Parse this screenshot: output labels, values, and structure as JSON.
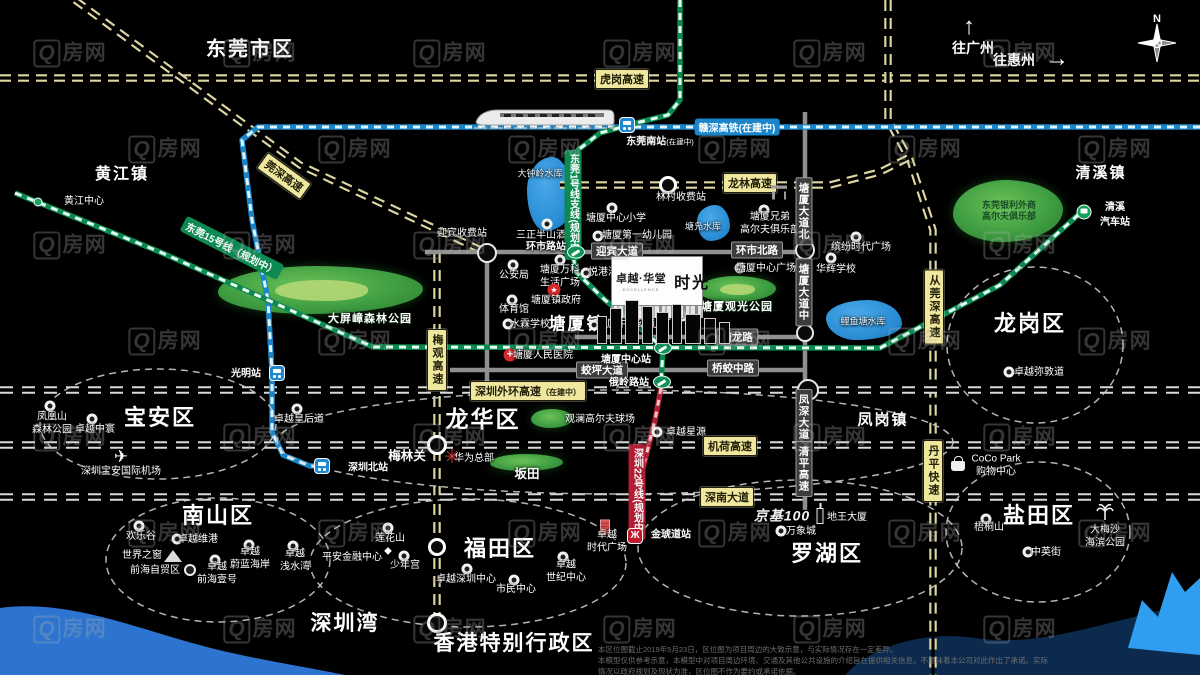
{
  "meta": {
    "title": "卓越·华堂 时光 区位图",
    "width": 1200,
    "height": 675
  },
  "colors": {
    "background": "#000000",
    "highway_label_bg": "#efe79e",
    "highway_dash": "#ddd6a0",
    "boundary_dash": "#d9d9d9",
    "road_gray": "#8f8f8f",
    "rail_green": "#0c8a52",
    "rail_cyan": "#1a86c9",
    "rail_red": "#b01e33",
    "park_green": "#3f9e42",
    "lake_blue": "#2b8fd6",
    "water_left": "#2c74cf",
    "water_navy": "#0c2a4e",
    "water_bright": "#2f9df0"
  },
  "property_logo": {
    "name": "卓越·华堂",
    "sub": "EXCELLENCE",
    "product": "时光"
  },
  "nav": {
    "to_guangzhou": "往广州",
    "to_huizhou": "往惠州",
    "north": "N"
  },
  "watermark": {
    "q": "Q",
    "text": "房网"
  },
  "disclaimer": {
    "line1": "本区位图截止2019年5月23日，区位图为项目周边的大致示意，与实际情况存在一定差异。",
    "line2": "本模型仅供参考示意，本模型中对项目周边环境、交通及其他公共设施的介绍旨在提供相关信息，不意味着本公司对此作出了承诺。实际情况以政府规划及现状为准，区位图不作为要约或承诺依据。"
  },
  "regions": [
    {
      "t": "东莞市区",
      "x": 250,
      "y": 47,
      "s": 20
    },
    {
      "t": "黄江镇",
      "x": 122,
      "y": 172,
      "s": 16
    },
    {
      "t": "清溪镇",
      "x": 1101,
      "y": 172,
      "s": 15
    },
    {
      "t": "塘厦镇",
      "x": 577,
      "y": 322,
      "s": 17
    },
    {
      "t": "凤岗镇",
      "x": 883,
      "y": 419,
      "s": 15
    },
    {
      "t": "龙岗区",
      "x": 1030,
      "y": 322,
      "s": 22
    },
    {
      "t": "宝安区",
      "x": 160,
      "y": 416,
      "s": 22
    },
    {
      "t": "龙华区",
      "x": 483,
      "y": 417,
      "s": 23
    },
    {
      "t": "南山区",
      "x": 218,
      "y": 514,
      "s": 22
    },
    {
      "t": "福田区",
      "x": 500,
      "y": 547,
      "s": 22
    },
    {
      "t": "罗湖区",
      "x": 827,
      "y": 552,
      "s": 22
    },
    {
      "t": "盐田区",
      "x": 1039,
      "y": 514,
      "s": 22
    },
    {
      "t": "深圳湾",
      "x": 345,
      "y": 622,
      "s": 21
    },
    {
      "t": "香港特别行政区",
      "x": 514,
      "y": 642,
      "s": 21
    }
  ],
  "park_labels": [
    {
      "t": "大屏嶂森林公园",
      "x": 370,
      "y": 318
    },
    {
      "t": "塘厦观光公园",
      "x": 737,
      "y": 306
    }
  ],
  "pois": [
    {
      "t": "大钟岭水库",
      "x": 540,
      "y": 174,
      "cls": "lake-label"
    },
    {
      "t": "塘凫水库",
      "x": 703,
      "y": 227,
      "cls": "lake-label"
    },
    {
      "t": "鲤鱼塘水库",
      "x": 863,
      "y": 322,
      "cls": "lake-label"
    },
    {
      "t": "林村收费站",
      "x": 681,
      "y": 198
    },
    {
      "t": "三正半山酒店",
      "x": 546,
      "y": 236,
      "icon": "dot",
      "ix": 547,
      "iy": 224
    },
    {
      "t": "塘厦中心小学",
      "x": 616,
      "y": 219,
      "icon": "dot",
      "ix": 612,
      "iy": 208
    },
    {
      "t": "塘厦第一幼儿园",
      "x": 637,
      "y": 236,
      "icon": "dot",
      "ix": 598,
      "iy": 236
    },
    {
      "t": "塘厦中心幼儿园",
      "x": 632,
      "y": 325,
      "icon": "dot",
      "ix": 594,
      "iy": 325
    },
    {
      "t": "迎宾收费站",
      "x": 462,
      "y": 234
    },
    {
      "t": "公安局",
      "x": 514,
      "y": 276,
      "icon": "dot",
      "ix": 513,
      "iy": 265
    },
    {
      "t": "塘厦万科\n生活广场",
      "x": 560,
      "y": 277,
      "icon": "dot",
      "ix": 560,
      "iy": 260
    },
    {
      "t": "悦港汇",
      "x": 603,
      "y": 273,
      "icon": "dot",
      "ix": 586,
      "iy": 273
    },
    {
      "t": "塘厦镇政府",
      "x": 556,
      "y": 301,
      "icon": "red-star",
      "ix": 554,
      "iy": 290
    },
    {
      "t": "体育馆",
      "x": 514,
      "y": 310,
      "icon": "dot",
      "ix": 512,
      "iy": 300
    },
    {
      "t": "水霖学校",
      "x": 530,
      "y": 325,
      "icon": "dot",
      "ix": 508,
      "iy": 324
    },
    {
      "t": "塘厦实验小学",
      "x": 655,
      "y": 317,
      "icon": "dot",
      "ix": 682,
      "iy": 316
    },
    {
      "t": "塘厦人民医院",
      "x": 543,
      "y": 356,
      "icon": "red-cross",
      "ix": 510,
      "iy": 355
    },
    {
      "t": "塘厦中心广场",
      "x": 766,
      "y": 269,
      "icon": "dot",
      "ix": 740,
      "iy": 268
    },
    {
      "t": "华辉学校",
      "x": 836,
      "y": 270,
      "icon": "dot",
      "ix": 831,
      "iy": 258
    },
    {
      "t": "缤纷时代广场",
      "x": 861,
      "y": 248,
      "icon": "dot",
      "ix": 856,
      "iy": 237
    },
    {
      "t": "塘厦兄弟\n高尔夫俱乐部",
      "x": 770,
      "y": 224,
      "icon": "dot",
      "ix": 764,
      "iy": 210
    },
    {
      "t": "东莞银利外商\n高尔夫俱乐部",
      "x": 1009,
      "y": 211,
      "cls": "on-green"
    },
    {
      "t": "卓越星源",
      "x": 686,
      "y": 433,
      "icon": "dot",
      "ix": 657,
      "iy": 432
    },
    {
      "t": "华为总部",
      "x": 474,
      "y": 459,
      "icon": "flower-red",
      "ix": 452,
      "iy": 458
    },
    {
      "t": "观澜高尔夫球场",
      "x": 600,
      "y": 420
    },
    {
      "t": "坂田",
      "x": 527,
      "y": 475,
      "cls": "mid"
    },
    {
      "t": "梅林关",
      "x": 407,
      "y": 457,
      "cls": "mid"
    },
    {
      "t": "卓越皇后道",
      "x": 299,
      "y": 420,
      "icon": "dot",
      "ix": 297,
      "iy": 409
    },
    {
      "t": "卓越中寰",
      "x": 95,
      "y": 430,
      "icon": "dot",
      "ix": 92,
      "iy": 419
    },
    {
      "t": "凤凰山\n森林公园",
      "x": 52,
      "y": 424,
      "icon": "dot",
      "ix": 50,
      "iy": 406
    },
    {
      "t": "深圳宝安国际机场",
      "x": 121,
      "y": 472,
      "icon": "plane",
      "ix": 121,
      "iy": 457
    },
    {
      "t": "欢乐谷",
      "x": 141,
      "y": 537,
      "icon": "dot",
      "ix": 139,
      "iy": 526
    },
    {
      "t": "卓越维港",
      "x": 198,
      "y": 540,
      "icon": "dot",
      "ix": 177,
      "iy": 539
    },
    {
      "t": "世界之窗",
      "x": 142,
      "y": 556,
      "icon": "pyramid",
      "ix": 173,
      "iy": 556
    },
    {
      "t": "前海自贸区",
      "x": 155,
      "y": 571,
      "icon": "swirl",
      "ix": 190,
      "iy": 570
    },
    {
      "t": "卓越\n前海壹号",
      "x": 217,
      "y": 574,
      "icon": "dot",
      "ix": 215,
      "iy": 560
    },
    {
      "t": "卓越\n蔚蓝海岸",
      "x": 250,
      "y": 559,
      "icon": "dot",
      "ix": 249,
      "iy": 545
    },
    {
      "t": "卓越\n浅水湾",
      "x": 295,
      "y": 561,
      "icon": "dot",
      "ix": 293,
      "iy": 546
    },
    {
      "t": "莲花山",
      "x": 390,
      "y": 539,
      "icon": "dot",
      "ix": 388,
      "iy": 528
    },
    {
      "t": "平安金融中心",
      "x": 352,
      "y": 558,
      "icon": "sparkle",
      "ix": 388,
      "iy": 551
    },
    {
      "t": "少年宫",
      "x": 405,
      "y": 566,
      "icon": "dot",
      "ix": 404,
      "iy": 556
    },
    {
      "t": "卓越深圳中心",
      "x": 466,
      "y": 580,
      "icon": "dot",
      "ix": 467,
      "iy": 569
    },
    {
      "t": "市民中心",
      "x": 516,
      "y": 590,
      "icon": "dot",
      "ix": 514,
      "iy": 580
    },
    {
      "t": "卓越\n世纪中心",
      "x": 566,
      "y": 572,
      "icon": "dot",
      "ix": 563,
      "iy": 557
    },
    {
      "t": "卓越\n时代广场",
      "x": 607,
      "y": 542,
      "icon": "red-building",
      "ix": 605,
      "iy": 527
    },
    {
      "t": "京基100",
      "x": 782,
      "y": 516,
      "cls": "kk-logo"
    },
    {
      "t": "地王大厦",
      "x": 847,
      "y": 518,
      "icon": "building",
      "ix": 820,
      "iy": 516
    },
    {
      "t": "万象城",
      "x": 801,
      "y": 532,
      "icon": "dot",
      "ix": 781,
      "iy": 531
    },
    {
      "t": "CoCo Park\n购物中心",
      "x": 996,
      "y": 466,
      "icon": "bag",
      "ix": 958,
      "iy": 466
    },
    {
      "t": "梧桐山",
      "x": 989,
      "y": 528,
      "icon": "dot",
      "ix": 986,
      "iy": 519
    },
    {
      "t": "大梅沙\n海滨公园",
      "x": 1105,
      "y": 537,
      "icon": "palm",
      "ix": 1105,
      "iy": 512
    },
    {
      "t": "中英街",
      "x": 1046,
      "y": 553,
      "icon": "dot",
      "ix": 1028,
      "iy": 552
    },
    {
      "t": "卓越弥敦道",
      "x": 1039,
      "y": 373,
      "icon": "dot",
      "ix": 1009,
      "iy": 372
    },
    {
      "t": "黄江中心",
      "x": 84,
      "y": 202,
      "icon": "green-dot",
      "ix": 38,
      "iy": 202
    }
  ],
  "highway_labels": [
    {
      "t": "虎岗高速",
      "x": 622,
      "y": 79
    },
    {
      "t": "龙林高速",
      "x": 750,
      "y": 183
    },
    {
      "t": "深圳外环高速",
      "small": "（在建中）",
      "x": 528,
      "y": 391
    },
    {
      "t": "机荷高速",
      "x": 730,
      "y": 446
    },
    {
      "t": "深南大道",
      "x": 727,
      "y": 497
    },
    {
      "t": "梅观高速",
      "x": 437,
      "y": 360,
      "v": true
    },
    {
      "t": "从莞深高速",
      "x": 934,
      "y": 307,
      "v": true
    },
    {
      "t": "丹平快速",
      "x": 933,
      "y": 471,
      "v": true
    },
    {
      "t": "莞深高速",
      "x": 284,
      "y": 176,
      "rot": 36
    }
  ],
  "gray_labels": [
    {
      "t": "迎宾大道",
      "x": 617,
      "y": 251
    },
    {
      "t": "环市北路",
      "x": 757,
      "y": 250
    },
    {
      "t": "塘龙路",
      "x": 737,
      "y": 337
    },
    {
      "t": "桥蛟中路",
      "x": 733,
      "y": 368
    },
    {
      "t": "蛟坪大道",
      "x": 602,
      "y": 370
    },
    {
      "t": "塘厦大道北",
      "x": 804,
      "y": 211,
      "v": true
    },
    {
      "t": "塘厦大道中",
      "x": 804,
      "y": 292,
      "v": true
    },
    {
      "t": "凤深大道",
      "x": 804,
      "y": 417,
      "v": true
    },
    {
      "t": "清平高速",
      "x": 804,
      "y": 469,
      "v": true
    }
  ],
  "rail_labels": [
    {
      "t": "赣深高铁(在建中)",
      "x": 737,
      "y": 127,
      "bg": "#1a86c9"
    },
    {
      "t": "东莞1号线支线(规划中)",
      "x": 573,
      "y": 205,
      "bg": "#0c8a52",
      "v": true
    },
    {
      "t": "东莞15号线（规划中）",
      "x": 232,
      "y": 248,
      "bg": "#0c8a52",
      "rot": 27
    },
    {
      "t": "深圳22号线(规划中)",
      "x": 637,
      "y": 492,
      "bg": "#b01e33",
      "v": true
    }
  ],
  "stations": [
    {
      "type": "train-blue",
      "x": 627,
      "y": 125,
      "label": "东莞南站(在建中)",
      "lx": 660,
      "ly": 140
    },
    {
      "type": "train-blue",
      "x": 277,
      "y": 373,
      "label": "光明站",
      "lx": 246,
      "ly": 372
    },
    {
      "type": "train-blue",
      "x": 322,
      "y": 466,
      "label": "深圳北站",
      "lx": 368,
      "ly": 466
    },
    {
      "type": "train-green",
      "x": 576,
      "y": 252,
      "label": "环市路站",
      "lx": 546,
      "ly": 245
    },
    {
      "type": "train-green",
      "x": 663,
      "y": 348,
      "label": "塘厦中心站",
      "lx": 626,
      "ly": 358
    },
    {
      "type": "train-green",
      "x": 662,
      "y": 382,
      "label": "俄岭路站",
      "lx": 629,
      "ly": 381
    },
    {
      "type": "metro-red",
      "x": 635,
      "y": 536,
      "label": "金琥道站",
      "lx": 671,
      "ly": 533,
      "glyph": "Ж"
    },
    {
      "type": "bus-green",
      "x": 1084,
      "y": 212,
      "label": "清溪\n汽车站",
      "lx": 1115,
      "ly": 213
    }
  ],
  "circles": [
    {
      "x": 668,
      "y": 185,
      "r": 9,
      "cls": "toll"
    },
    {
      "x": 487,
      "y": 253,
      "r": 10,
      "cls": "junction"
    },
    {
      "x": 805,
      "y": 250,
      "r": 10,
      "cls": "junction"
    },
    {
      "x": 805,
      "y": 333,
      "r": 9,
      "cls": "junction"
    },
    {
      "x": 808,
      "y": 390,
      "r": 11,
      "cls": "junction"
    },
    {
      "x": 437,
      "y": 445,
      "r": 10,
      "cls": "toll"
    },
    {
      "x": 437,
      "y": 547,
      "r": 9,
      "cls": "toll"
    },
    {
      "x": 437,
      "y": 623,
      "r": 10,
      "cls": "toll"
    }
  ],
  "parks": [
    {
      "x": 218,
      "y": 266,
      "w": 205,
      "h": 48,
      "inner": true
    },
    {
      "x": 698,
      "y": 276,
      "w": 78,
      "h": 26,
      "inner": true
    },
    {
      "x": 953,
      "y": 180,
      "w": 110,
      "h": 62,
      "inner": false
    },
    {
      "x": 531,
      "y": 409,
      "w": 42,
      "h": 19,
      "inner": false
    },
    {
      "x": 490,
      "y": 454,
      "w": 73,
      "h": 17,
      "inner": false
    }
  ],
  "lakes": [
    {
      "x": 527,
      "y": 157,
      "w": 46,
      "h": 74
    },
    {
      "x": 697,
      "y": 205,
      "w": 33,
      "h": 36
    },
    {
      "x": 826,
      "y": 300,
      "w": 76,
      "h": 40
    }
  ],
  "water_paths": [
    {
      "d": "M0 608 C 60 600, 120 622, 185 641 C 240 657, 290 664, 345 675 L 0 675 Z",
      "fill": "#2c74cf"
    },
    {
      "d": "M845 675 C 870 648, 920 630, 975 638 C 1030 646, 1080 630, 1130 618 L 1200 600 L 1200 675 Z",
      "fill": "#0c2a4e"
    },
    {
      "d": "M1128 648 L1142 600 L1158 617 L1172 572 L1185 592 L1200 578 L1200 655 Z",
      "fill": "#2f9df0"
    }
  ],
  "roads": [
    {
      "style": "hw",
      "pts": [
        [
          0,
          78
        ],
        [
          1200,
          78
        ]
      ]
    },
    {
      "style": "hw",
      "pts": [
        [
          75,
          0
        ],
        [
          300,
          165
        ],
        [
          487,
          253
        ]
      ]
    },
    {
      "style": "hw",
      "pts": [
        [
          888,
          0
        ],
        [
          888,
          120
        ],
        [
          910,
          160
        ],
        [
          933,
          230
        ],
        [
          933,
          675
        ]
      ]
    },
    {
      "style": "hw",
      "pts": [
        [
          560,
          185
        ],
        [
          830,
          185
        ],
        [
          880,
          172
        ],
        [
          912,
          156
        ]
      ]
    },
    {
      "style": "hw",
      "pts": [
        [
          437,
          252
        ],
        [
          437,
          625
        ]
      ]
    },
    {
      "style": "bd",
      "pts": [
        [
          0,
          390
        ],
        [
          1200,
          390
        ]
      ]
    },
    {
      "style": "bd",
      "pts": [
        [
          0,
          445
        ],
        [
          1200,
          445
        ]
      ]
    },
    {
      "style": "bd",
      "pts": [
        [
          0,
          497
        ],
        [
          1200,
          497
        ]
      ]
    },
    {
      "style": "gray",
      "pts": [
        [
          425,
          252
        ],
        [
          805,
          252
        ]
      ]
    },
    {
      "style": "gray",
      "pts": [
        [
          487,
          253
        ],
        [
          487,
          390
        ]
      ]
    },
    {
      "style": "gray",
      "pts": [
        [
          575,
          337
        ],
        [
          805,
          337
        ]
      ]
    },
    {
      "style": "gray",
      "pts": [
        [
          450,
          370
        ],
        [
          805,
          370
        ]
      ]
    },
    {
      "style": "gray",
      "pts": [
        [
          805,
          112
        ],
        [
          805,
          510
        ]
      ]
    },
    {
      "style": "rail-cyan",
      "pts": [
        [
          1200,
          127
        ],
        [
          258,
          127
        ],
        [
          242,
          140
        ],
        [
          252,
          220
        ],
        [
          268,
          300
        ],
        [
          272,
          373
        ],
        [
          272,
          432
        ],
        [
          283,
          455
        ],
        [
          310,
          466
        ],
        [
          330,
          466
        ]
      ]
    },
    {
      "style": "rail-green",
      "pts": [
        [
          680,
          0
        ],
        [
          680,
          100
        ],
        [
          668,
          115
        ],
        [
          640,
          122
        ],
        [
          600,
          133
        ],
        [
          578,
          150
        ],
        [
          573,
          170
        ],
        [
          573,
          255
        ],
        [
          576,
          272
        ],
        [
          605,
          300
        ],
        [
          645,
          332
        ],
        [
          663,
          348
        ],
        [
          661,
          385
        ]
      ]
    },
    {
      "style": "rail-green",
      "pts": [
        [
          373,
          347
        ],
        [
          880,
          348
        ],
        [
          1000,
          285
        ],
        [
          1078,
          215
        ]
      ]
    },
    {
      "style": "rail-green",
      "pts": [
        [
          15,
          193
        ],
        [
          160,
          252
        ],
        [
          290,
          310
        ],
        [
          373,
          347
        ]
      ]
    },
    {
      "style": "rail-red",
      "pts": [
        [
          661,
          388
        ],
        [
          655,
          420
        ],
        [
          640,
          480
        ],
        [
          636,
          533
        ]
      ]
    }
  ],
  "district_ellipses": [
    {
      "cx": 1035,
      "cy": 345,
      "rx": 88,
      "ry": 78
    },
    {
      "cx": 158,
      "cy": 424,
      "rx": 118,
      "ry": 55
    },
    {
      "cx": 218,
      "cy": 560,
      "rx": 112,
      "ry": 62
    },
    {
      "cx": 468,
      "cy": 563,
      "rx": 158,
      "ry": 64
    },
    {
      "cx": 800,
      "cy": 548,
      "rx": 162,
      "ry": 68
    },
    {
      "cx": 1038,
      "cy": 532,
      "rx": 92,
      "ry": 70
    },
    {
      "cx": 615,
      "cy": 442,
      "rx": 338,
      "ry": 52
    }
  ]
}
